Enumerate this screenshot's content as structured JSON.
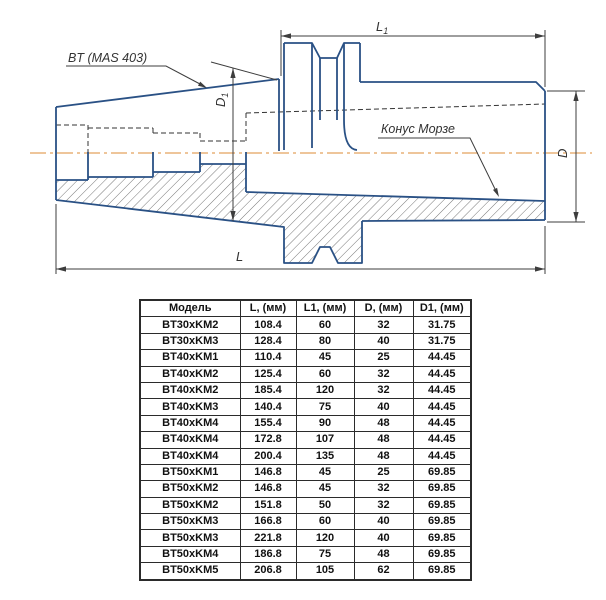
{
  "drawing": {
    "labels": {
      "shank_standard": "BT (MAS 403)",
      "morse_taper": "Конус Морзе"
    },
    "dimensions": {
      "l1": {
        "main": "L",
        "sub": "1"
      },
      "d1": {
        "main": "D",
        "sub": "1"
      },
      "d": {
        "main": "D"
      },
      "l": {
        "main": "L"
      }
    },
    "colors": {
      "outline_blue": "#2a5185",
      "centerline_orange": "#ecbd8c",
      "dimension_gray": "#3d3d3d",
      "hatch_gray": "#4a4a4a"
    }
  },
  "table": {
    "headers": [
      "Модель",
      "L, (мм)",
      "L1, (мм)",
      "D, (мм)",
      "D1, (мм)"
    ],
    "rows": [
      [
        "BT30xKM2",
        "108.4",
        "60",
        "32",
        "31.75"
      ],
      [
        "BT30xKM3",
        "128.4",
        "80",
        "40",
        "31.75"
      ],
      [
        "BT40xKM1",
        "110.4",
        "45",
        "25",
        "44.45"
      ],
      [
        "BT40xKM2",
        "125.4",
        "60",
        "32",
        "44.45"
      ],
      [
        "BT40xKM2",
        "185.4",
        "120",
        "32",
        "44.45"
      ],
      [
        "BT40xKM3",
        "140.4",
        "75",
        "40",
        "44.45"
      ],
      [
        "BT40xKM4",
        "155.4",
        "90",
        "48",
        "44.45"
      ],
      [
        "BT40xKM4",
        "172.8",
        "107",
        "48",
        "44.45"
      ],
      [
        "BT40xKM4",
        "200.4",
        "135",
        "48",
        "44.45"
      ],
      [
        "BT50xKM1",
        "146.8",
        "45",
        "25",
        "69.85"
      ],
      [
        "BT50xKM2",
        "146.8",
        "45",
        "32",
        "69.85"
      ],
      [
        "BT50xKM2",
        "151.8",
        "50",
        "32",
        "69.85"
      ],
      [
        "BT50xKM3",
        "166.8",
        "60",
        "40",
        "69.85"
      ],
      [
        "BT50xKM3",
        "221.8",
        "120",
        "40",
        "69.85"
      ],
      [
        "BT50xKM4",
        "186.8",
        "75",
        "48",
        "69.85"
      ],
      [
        "BT50xKM5",
        "206.8",
        "105",
        "62",
        "69.85"
      ]
    ]
  }
}
